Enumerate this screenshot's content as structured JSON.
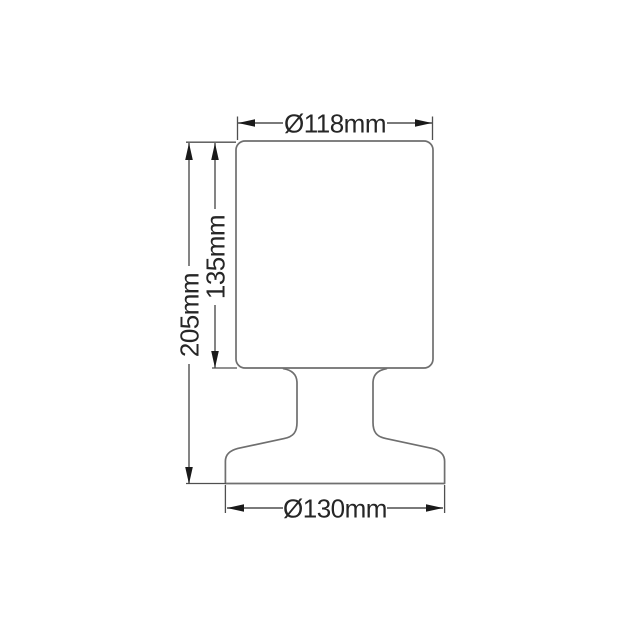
{
  "diagram": {
    "labels": {
      "shade_diameter": "Ø118mm",
      "shade_height": "135mm",
      "total_height": "205mm",
      "base_diameter": "Ø130mm"
    }
  },
  "colors": {
    "background": "#ffffff",
    "outline": "#6f6f6f",
    "dimension": "#4f4f4f",
    "arrow": "#1a1a1a",
    "label": "#262626"
  }
}
